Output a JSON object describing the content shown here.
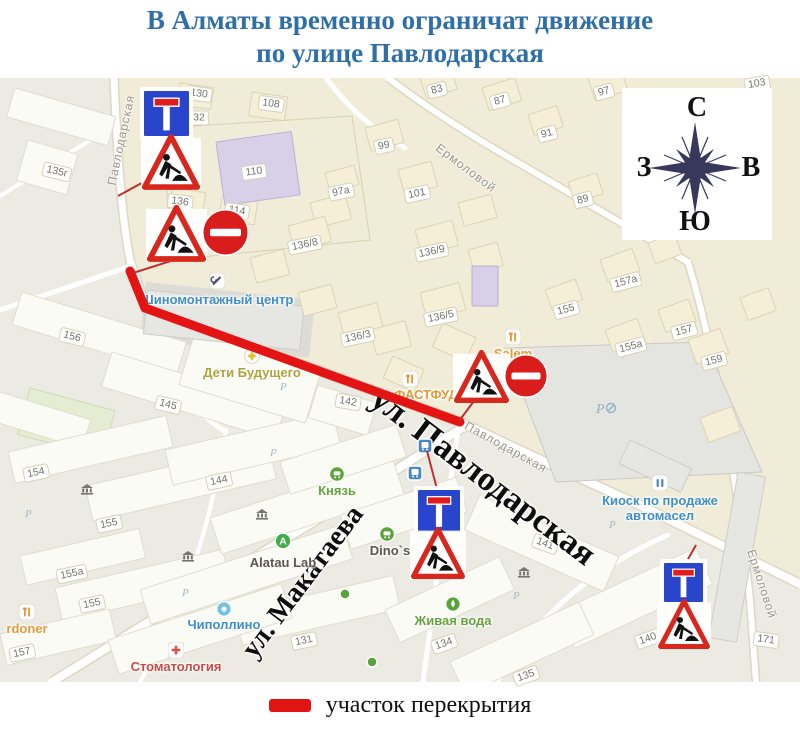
{
  "title": {
    "line1": "В Алматы временно ограничат движение",
    "line2": "по улице Павлодарская"
  },
  "legend": {
    "label": "участок перекрытия",
    "color": "#e21414"
  },
  "compass": {
    "north": "С",
    "south": "Ю",
    "west": "З",
    "east": "В"
  },
  "map": {
    "street_labels": [
      {
        "text": "Павлодарская",
        "x": 121,
        "y": 140,
        "rot": -78,
        "kind": "minor",
        "size": 12
      },
      {
        "text": "Ермоловой",
        "x": 466,
        "y": 168,
        "rot": 37,
        "kind": "minor",
        "size": 12
      },
      {
        "text": "Ермоловой",
        "x": 762,
        "y": 584,
        "rot": 72,
        "kind": "minor",
        "size": 12
      },
      {
        "text": "Павлодарская",
        "x": 506,
        "y": 447,
        "rot": 29,
        "kind": "minor",
        "size": 12
      },
      {
        "text": "ул. Павлодарская",
        "x": 483,
        "y": 477,
        "rot": 37,
        "kind": "major",
        "size": 34
      },
      {
        "text": "ул. Макатаева",
        "x": 303,
        "y": 582,
        "rot": -53,
        "kind": "major",
        "size": 28
      }
    ],
    "buildings": [
      {
        "n": "135г",
        "x": 57,
        "y": 172,
        "r": 14
      },
      {
        "n": "130",
        "x": 199,
        "y": 94,
        "r": 8
      },
      {
        "n": "32",
        "x": 199,
        "y": 118,
        "r": 0
      },
      {
        "n": "108",
        "x": 271,
        "y": 104,
        "r": 8
      },
      {
        "n": "110",
        "x": 254,
        "y": 172,
        "r": -8
      },
      {
        "n": "114",
        "x": 237,
        "y": 211,
        "r": 8
      },
      {
        "n": "136",
        "x": 180,
        "y": 202,
        "r": 8
      },
      {
        "n": "83",
        "x": 437,
        "y": 90,
        "r": -15
      },
      {
        "n": "87",
        "x": 500,
        "y": 101,
        "r": -15
      },
      {
        "n": "97",
        "x": 604,
        "y": 92,
        "r": -15
      },
      {
        "n": "103",
        "x": 757,
        "y": 84,
        "r": -10
      },
      {
        "n": "91",
        "x": 547,
        "y": 134,
        "r": -15
      },
      {
        "n": "99",
        "x": 384,
        "y": 146,
        "r": -12
      },
      {
        "n": "97а",
        "x": 341,
        "y": 192,
        "r": -12
      },
      {
        "n": "101",
        "x": 417,
        "y": 194,
        "r": -12
      },
      {
        "n": "89",
        "x": 583,
        "y": 200,
        "r": -15
      },
      {
        "n": "136/8",
        "x": 305,
        "y": 245,
        "r": -12
      },
      {
        "n": "136/9",
        "x": 432,
        "y": 252,
        "r": -12
      },
      {
        "n": "136/3",
        "x": 358,
        "y": 337,
        "r": -12
      },
      {
        "n": "136/5",
        "x": 441,
        "y": 317,
        "r": -12
      },
      {
        "n": "157а",
        "x": 626,
        "y": 282,
        "r": -15
      },
      {
        "n": "155",
        "x": 566,
        "y": 310,
        "r": -15
      },
      {
        "n": "157",
        "x": 684,
        "y": 331,
        "r": -15
      },
      {
        "n": "155а",
        "x": 631,
        "y": 347,
        "r": -15
      },
      {
        "n": "159",
        "x": 714,
        "y": 361,
        "r": -15
      },
      {
        "n": "156",
        "x": 72,
        "y": 337,
        "r": 14
      },
      {
        "n": "145",
        "x": 168,
        "y": 405,
        "r": 14
      },
      {
        "n": "142",
        "x": 348,
        "y": 402,
        "r": 10
      },
      {
        "n": "154",
        "x": 36,
        "y": 473,
        "r": -12
      },
      {
        "n": "144",
        "x": 219,
        "y": 481,
        "r": -12
      },
      {
        "n": "155",
        "x": 109,
        "y": 524,
        "r": -12
      },
      {
        "n": "155а",
        "x": 72,
        "y": 574,
        "r": -12
      },
      {
        "n": "155",
        "x": 92,
        "y": 604,
        "r": -12
      },
      {
        "n": "157",
        "x": 22,
        "y": 653,
        "r": -12
      },
      {
        "n": "131",
        "x": 304,
        "y": 641,
        "r": -12
      },
      {
        "n": "141",
        "x": 545,
        "y": 544,
        "r": 20
      },
      {
        "n": "134",
        "x": 444,
        "y": 644,
        "r": -20
      },
      {
        "n": "140",
        "x": 648,
        "y": 639,
        "r": -20
      },
      {
        "n": "135",
        "x": 526,
        "y": 676,
        "r": -20
      },
      {
        "n": "171",
        "x": 766,
        "y": 640,
        "r": 8
      }
    ],
    "pois": [
      {
        "label": "Шиномонтажный центр",
        "x": 217,
        "y": 299,
        "color": "#3f8ec6",
        "icon": "tools",
        "ix": 217,
        "iy": 281
      },
      {
        "label": "Дети Будущего",
        "x": 252,
        "y": 372,
        "color": "#b0a23c",
        "icon": "star-yellow",
        "ix": 252,
        "iy": 356
      },
      {
        "label": "Salem",
        "x": 513,
        "y": 353,
        "color": "#df9c3a",
        "icon": "fork",
        "ix": 513,
        "iy": 337
      },
      {
        "label": "ФАСТФУД",
        "x": 426,
        "y": 394,
        "color": "#df9c3a",
        "icon": "fork",
        "ix": 410,
        "iy": 379
      },
      {
        "label": "Князь",
        "x": 337,
        "y": 490,
        "color": "#67a43d",
        "icon": "cart",
        "ix": 337,
        "iy": 474
      },
      {
        "label": "Dino`s",
        "x": 390,
        "y": 550,
        "color": "#5a564d",
        "icon": "cart",
        "ix": 387,
        "iy": 534
      },
      {
        "label": "Alatau Lab",
        "x": 283,
        "y": 562,
        "color": "#5a564d",
        "icon": "alatau",
        "ix": 283,
        "iy": 541
      },
      {
        "label": "Чиполлино",
        "x": 224,
        "y": 624,
        "color": "#3f8ec6",
        "icon": "drop",
        "ix": 224,
        "iy": 609
      },
      {
        "label": "Стоматология",
        "x": 176,
        "y": 666,
        "color": "#cb4b42",
        "icon": "cross",
        "ix": 176,
        "iy": 650
      },
      {
        "label": "rdoner",
        "x": 27,
        "y": 628,
        "color": "#df9c3a",
        "icon": "fork",
        "ix": 27,
        "iy": 612
      },
      {
        "label": "Киоск по продаже\nавтомасел",
        "x": 660,
        "y": 500,
        "color": "#3f8ec6",
        "icon": "kiosk",
        "ix": 660,
        "iy": 483
      },
      {
        "label": "Живая вода",
        "x": 453,
        "y": 620,
        "color": "#67a43d",
        "icon": "drop-green",
        "ix": 453,
        "iy": 604
      }
    ],
    "icons": [
      {
        "type": "bus",
        "x": 425,
        "y": 446
      },
      {
        "type": "bus",
        "x": 415,
        "y": 473
      },
      {
        "type": "bank",
        "x": 87,
        "y": 489
      },
      {
        "type": "bank",
        "x": 188,
        "y": 556
      },
      {
        "type": "bank",
        "x": 524,
        "y": 572
      },
      {
        "type": "bank",
        "x": 262,
        "y": 514
      },
      {
        "type": "parking",
        "x": 280,
        "y": 386
      },
      {
        "type": "parking",
        "x": 270,
        "y": 452
      },
      {
        "type": "parking",
        "x": 182,
        "y": 592
      },
      {
        "type": "parking",
        "x": 25,
        "y": 513
      },
      {
        "type": "parking",
        "x": 609,
        "y": 524
      },
      {
        "type": "parking",
        "x": 513,
        "y": 595
      },
      {
        "type": "parking-main",
        "x": 596,
        "y": 408
      },
      {
        "type": "dot-green",
        "x": 345,
        "y": 594
      },
      {
        "type": "dot-green",
        "x": 372,
        "y": 662
      }
    ],
    "closure": {
      "color": "#e51414",
      "width": 9,
      "points": [
        [
          130,
          271
        ],
        [
          145,
          308
        ],
        [
          460,
          422
        ]
      ]
    },
    "pointers": {
      "color": "#c03030",
      "width": 2,
      "lines": [
        [
          [
            158,
            174
          ],
          [
            118,
            196
          ]
        ],
        [
          [
            196,
            253
          ],
          [
            133,
            273
          ]
        ],
        [
          [
            477,
            397
          ],
          [
            459,
            421
          ]
        ],
        [
          [
            437,
            489
          ],
          [
            427,
            451
          ]
        ],
        [
          [
            687,
            561
          ],
          [
            696,
            545
          ]
        ]
      ]
    },
    "sign_groups": [
      {
        "signs": [
          {
            "type": "dead_end",
            "x": 143,
            "y": 90,
            "s": 47
          },
          {
            "type": "roadworks",
            "x": 143,
            "y": 135,
            "s": 56
          }
        ]
      },
      {
        "signs": [
          {
            "type": "roadworks",
            "x": 148,
            "y": 206,
            "s": 57
          },
          {
            "type": "no_entry",
            "x": 202,
            "y": 209,
            "s": 47
          }
        ]
      },
      {
        "signs": [
          {
            "type": "roadworks",
            "x": 455,
            "y": 351,
            "s": 53
          },
          {
            "type": "no_entry",
            "x": 504,
            "y": 354,
            "s": 44
          }
        ]
      },
      {
        "signs": [
          {
            "type": "dead_end",
            "x": 417,
            "y": 489,
            "s": 44
          },
          {
            "type": "roadworks",
            "x": 412,
            "y": 528,
            "s": 52
          }
        ]
      },
      {
        "signs": [
          {
            "type": "dead_end",
            "x": 663,
            "y": 562,
            "s": 41
          },
          {
            "type": "roadworks",
            "x": 659,
            "y": 600,
            "s": 50
          }
        ]
      }
    ]
  }
}
